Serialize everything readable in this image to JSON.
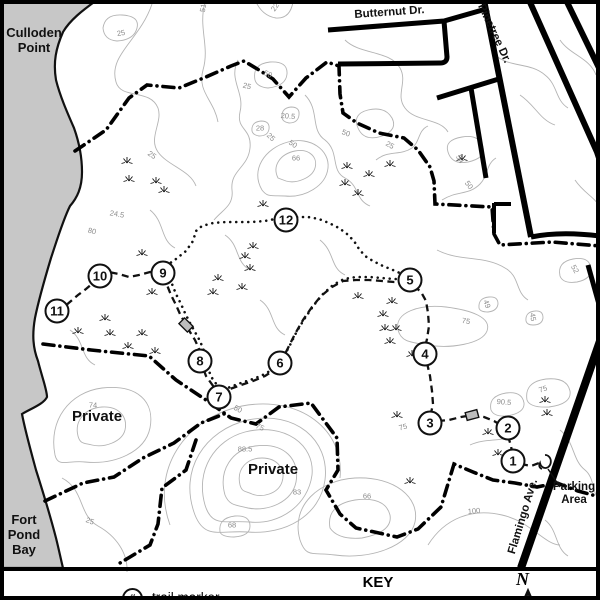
{
  "colors": {
    "water": "#c7c7c7",
    "contour": "#b4b4b4",
    "ink": "#111111",
    "structure_fill": "#bdbdbd"
  },
  "water_labels": {
    "culloden": [
      "Culloden",
      "Point"
    ],
    "fort_pond": [
      "Fort",
      "Pond",
      "Bay"
    ]
  },
  "area_labels": {
    "private_west": "Private",
    "private_south": "Private"
  },
  "roads": {
    "butternut": "Butternut Dr.",
    "pinetree": "Pinetree Dr.",
    "flamingo": "Flamingo Ave."
  },
  "parking": {
    "lines": [
      "Parking",
      "Area"
    ]
  },
  "key": {
    "title": "KEY",
    "item_symbol": "#",
    "item_label": "trail marker"
  },
  "compass": {
    "label": "N"
  },
  "trail_markers": [
    {
      "n": "1",
      "x": 513,
      "y": 461
    },
    {
      "n": "2",
      "x": 508,
      "y": 428
    },
    {
      "n": "3",
      "x": 430,
      "y": 423
    },
    {
      "n": "4",
      "x": 425,
      "y": 354
    },
    {
      "n": "5",
      "x": 410,
      "y": 280
    },
    {
      "n": "6",
      "x": 280,
      "y": 363
    },
    {
      "n": "7",
      "x": 219,
      "y": 397
    },
    {
      "n": "8",
      "x": 200,
      "y": 361
    },
    {
      "n": "9",
      "x": 163,
      "y": 273
    },
    {
      "n": "10",
      "x": 100,
      "y": 276
    },
    {
      "n": "11",
      "x": 57,
      "y": 311
    },
    {
      "n": "12",
      "x": 286,
      "y": 220
    }
  ],
  "contour_labels": [
    {
      "v": "25",
      "x": 121,
      "y": 33,
      "r": -10
    },
    {
      "v": "51",
      "x": 203,
      "y": 8,
      "r": -80
    },
    {
      "v": "22",
      "x": 275,
      "y": 7,
      "r": -55
    },
    {
      "v": "50",
      "x": 268,
      "y": 74,
      "r": 25
    },
    {
      "v": "25",
      "x": 247,
      "y": 86,
      "r": 15
    },
    {
      "v": "20.5",
      "x": 288,
      "y": 116,
      "r": 5
    },
    {
      "v": "28",
      "x": 260,
      "y": 128,
      "r": 0
    },
    {
      "v": "25",
      "x": 271,
      "y": 137,
      "r": 45
    },
    {
      "v": "50",
      "x": 293,
      "y": 144,
      "r": 35
    },
    {
      "v": "66",
      "x": 296,
      "y": 158,
      "r": 0
    },
    {
      "v": "25",
      "x": 152,
      "y": 155,
      "r": 35
    },
    {
      "v": "24.5",
      "x": 117,
      "y": 214,
      "r": 10
    },
    {
      "v": "80",
      "x": 92,
      "y": 231,
      "r": 15
    },
    {
      "v": "50",
      "x": 346,
      "y": 133,
      "r": 20
    },
    {
      "v": "25",
      "x": 390,
      "y": 145,
      "r": 30
    },
    {
      "v": "54",
      "x": 460,
      "y": 159,
      "r": 60
    },
    {
      "v": "50",
      "x": 469,
      "y": 185,
      "r": 55
    },
    {
      "v": "52",
      "x": 575,
      "y": 269,
      "r": 60
    },
    {
      "v": "49",
      "x": 487,
      "y": 304,
      "r": 70
    },
    {
      "v": "45",
      "x": 533,
      "y": 317,
      "r": 80
    },
    {
      "v": "75",
      "x": 466,
      "y": 321,
      "r": 10
    },
    {
      "v": "75",
      "x": 543,
      "y": 389,
      "r": -20
    },
    {
      "v": "90.5",
      "x": 504,
      "y": 402,
      "r": 5
    },
    {
      "v": "75",
      "x": 403,
      "y": 427,
      "r": -15
    },
    {
      "v": "74",
      "x": 93,
      "y": 405,
      "r": 0
    },
    {
      "v": "50",
      "x": 238,
      "y": 409,
      "r": 30
    },
    {
      "v": "75",
      "x": 260,
      "y": 427,
      "r": 25
    },
    {
      "v": "88.5",
      "x": 245,
      "y": 449,
      "r": 0
    },
    {
      "v": "68",
      "x": 232,
      "y": 525,
      "r": 0
    },
    {
      "v": "83",
      "x": 297,
      "y": 492,
      "r": 0
    },
    {
      "v": "66",
      "x": 367,
      "y": 496,
      "r": 0
    },
    {
      "v": "100",
      "x": 474,
      "y": 511,
      "r": -5
    },
    {
      "v": "25",
      "x": 90,
      "y": 521,
      "r": 20
    }
  ],
  "marsh": [
    [
      127,
      161
    ],
    [
      129,
      179
    ],
    [
      156,
      181
    ],
    [
      164,
      190
    ],
    [
      347,
      166
    ],
    [
      369,
      174
    ],
    [
      390,
      164
    ],
    [
      345,
      183
    ],
    [
      358,
      193
    ],
    [
      462,
      158
    ],
    [
      263,
      204
    ],
    [
      253,
      246
    ],
    [
      245,
      256
    ],
    [
      250,
      268
    ],
    [
      218,
      278
    ],
    [
      242,
      287
    ],
    [
      213,
      292
    ],
    [
      152,
      292
    ],
    [
      142,
      253
    ],
    [
      105,
      318
    ],
    [
      78,
      331
    ],
    [
      110,
      333
    ],
    [
      142,
      333
    ],
    [
      128,
      346
    ],
    [
      155,
      351
    ],
    [
      358,
      296
    ],
    [
      392,
      301
    ],
    [
      383,
      314
    ],
    [
      385,
      328
    ],
    [
      396,
      328
    ],
    [
      390,
      341
    ],
    [
      412,
      354
    ],
    [
      397,
      415
    ],
    [
      410,
      481
    ],
    [
      488,
      432
    ],
    [
      498,
      453
    ],
    [
      545,
      400
    ],
    [
      547,
      413
    ]
  ],
  "structures": [
    {
      "x": 186,
      "y": 325,
      "r": 45
    },
    {
      "x": 472,
      "y": 415,
      "r": -15
    }
  ]
}
